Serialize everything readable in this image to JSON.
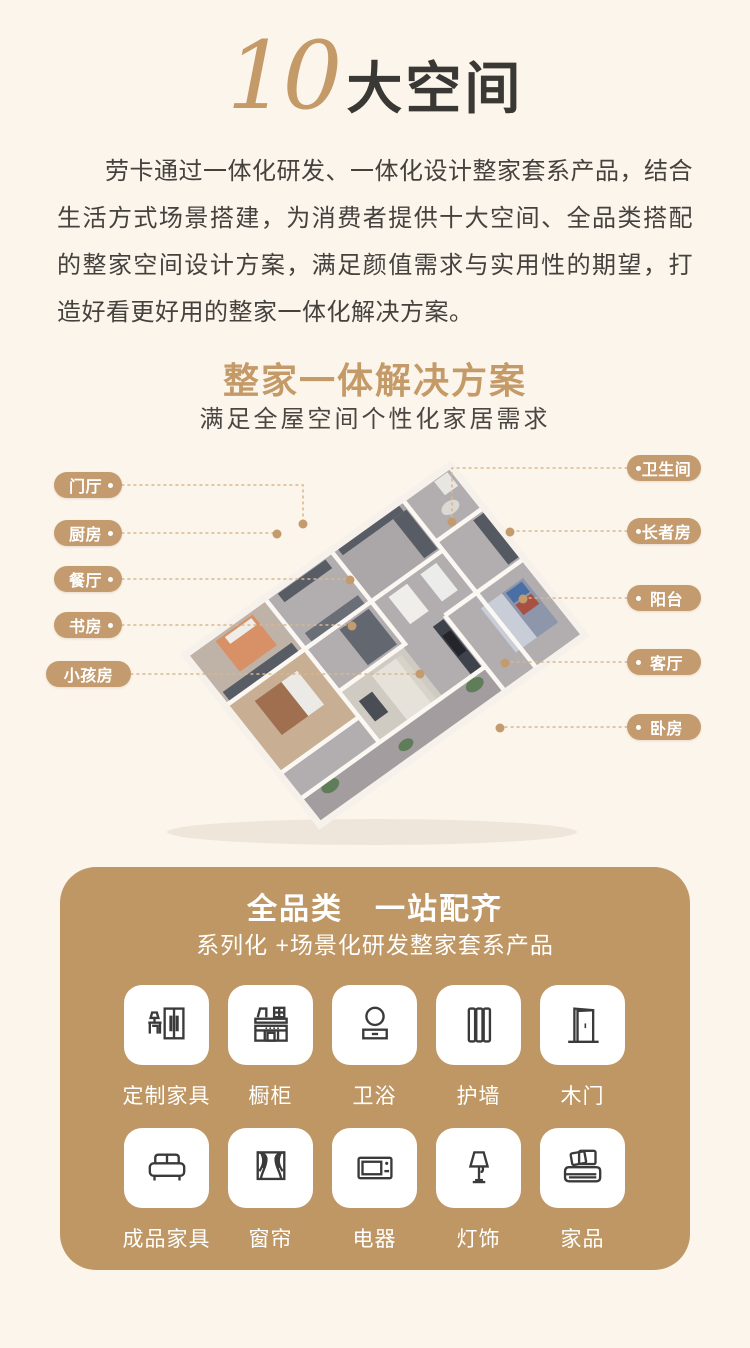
{
  "header": {
    "number": "10",
    "title": "大空间"
  },
  "intro": {
    "text": "劳卡通过一体化研发、一体化设计整家套系产品，结合生活方式场景搭建，为消费者提供十大空间、全品类搭配的整家空间设计方案，满足颜值需求与实用性的期望，打造好看更好用的整家一体化解决方案。"
  },
  "solution": {
    "title": "整家一体解决方案",
    "subtitle": "满足全屋空间个性化家居需求"
  },
  "plan": {
    "left_labels": [
      "门厅",
      "厨房",
      "餐厅",
      "书房",
      "小孩房"
    ],
    "right_labels": [
      "卫生间",
      "长者房",
      "阳台",
      "客厅",
      "卧房"
    ]
  },
  "categories": {
    "title": "全品类　一站配齐",
    "subtitle": "系列化 +场景化研发整家套系产品",
    "items": [
      {
        "label": "定制家具",
        "icon": "wardrobe-desk-icon"
      },
      {
        "label": "橱柜",
        "icon": "kitchen-cabinet-icon"
      },
      {
        "label": "卫浴",
        "icon": "bath-mirror-icon"
      },
      {
        "label": "护墙",
        "icon": "wall-panel-icon"
      },
      {
        "label": "木门",
        "icon": "wood-door-icon"
      },
      {
        "label": "成品家具",
        "icon": "sofa-icon"
      },
      {
        "label": "窗帘",
        "icon": "curtain-icon"
      },
      {
        "label": "电器",
        "icon": "microwave-icon"
      },
      {
        "label": "灯饰",
        "icon": "lamp-icon"
      },
      {
        "label": "家品",
        "icon": "bedding-icon"
      }
    ]
  },
  "colors": {
    "background": "#FCF5EB",
    "accent_gold": "#C49A68",
    "pill_tan": "#C39B6E",
    "panel_tan": "#BF9765",
    "text_dark": "#3A3834",
    "leader_line": "#D8B88C"
  }
}
